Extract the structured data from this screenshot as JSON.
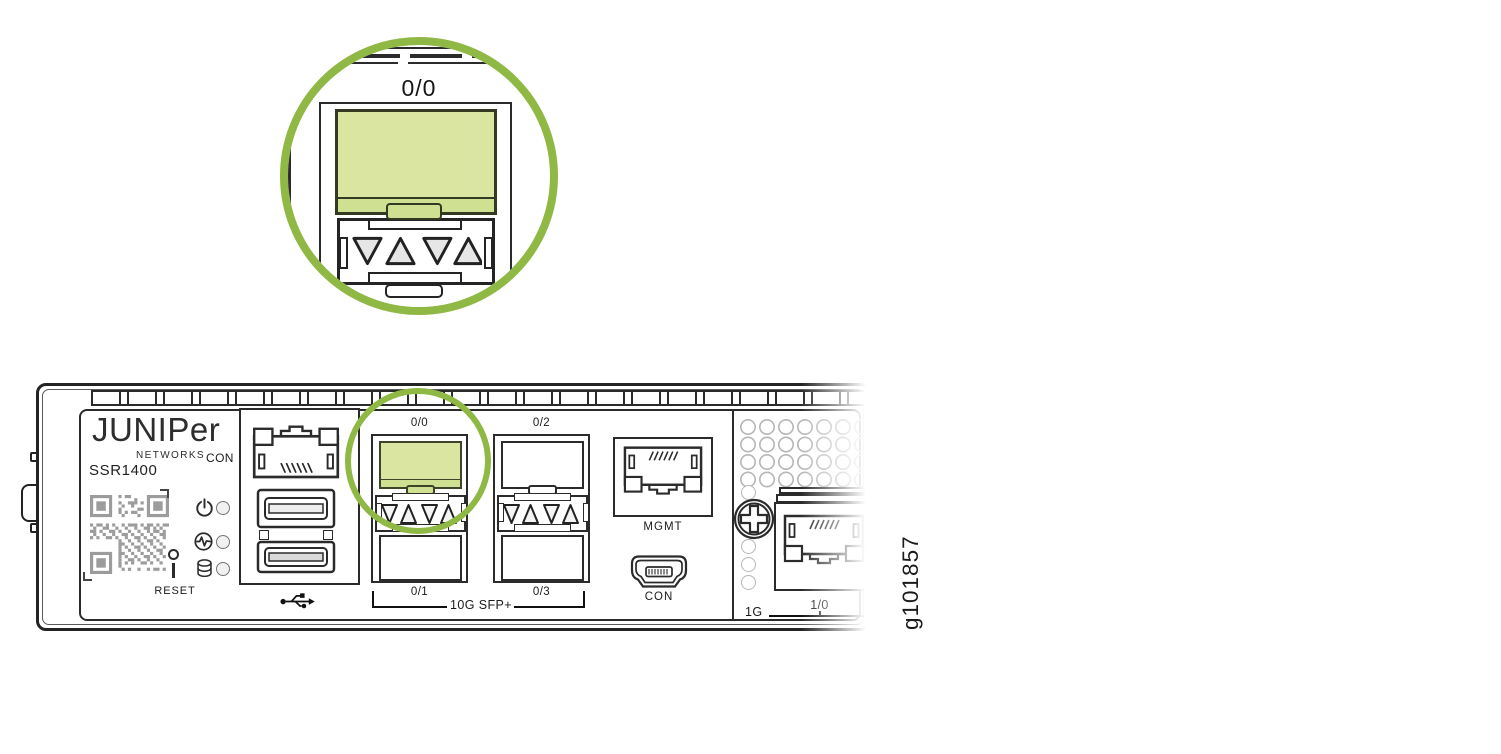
{
  "figure_id": "g101857",
  "colors": {
    "ring_green": "#8fb845",
    "port_fill": "#d9e5a1",
    "port_fill_dark": "#cfe092",
    "port_border": "#343a22",
    "line": "#2b2b2b",
    "vent_gray": "#b6b6b6",
    "qr_gray": "#9c9c9c",
    "triangle_gray": "#e6e6e6",
    "led_fill": "#f1f1f1"
  },
  "callout": {
    "port_label": "0/0"
  },
  "device": {
    "logo": "JUNIPer",
    "logo_sub": "NETWORKS",
    "model": "SSR1400",
    "console_label": "CON",
    "reset_label": "RESET",
    "mgmt_label": "MGMT",
    "mini_con_label": "CON",
    "sfp_ports": [
      "0/0",
      "0/1",
      "0/2",
      "0/3"
    ],
    "sfp_group_label": "10G SFP+",
    "ge_port_label": "1/0",
    "ge_group_label": "1G"
  },
  "icons": {
    "power": "power-symbol",
    "status": "pulse-in-circle",
    "storage": "disk-cylinder",
    "usb": "usb-trident",
    "screw": "phillips-head",
    "qr": "qr-code",
    "reset": "push-button"
  }
}
